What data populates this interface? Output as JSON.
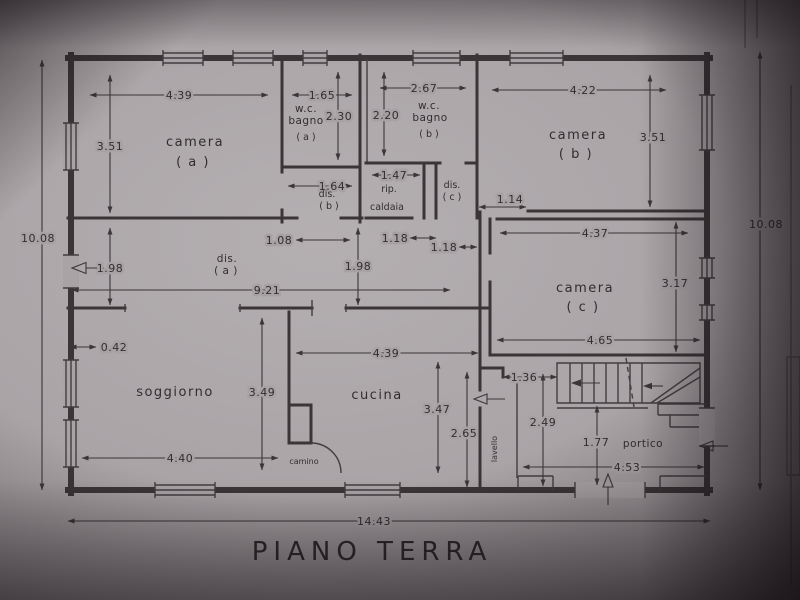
{
  "title": "PIANO TERRA",
  "outer": {
    "left": "10.08",
    "right": "10.08",
    "bottom": "14.43"
  },
  "rooms": {
    "camera_a": {
      "name": "camera",
      "tag": "( a )",
      "width": "4.39",
      "height": "3.51"
    },
    "bagno_a": {
      "l1": "w.c.",
      "l2": "bagno",
      "tag": "( a )",
      "width": "1.65",
      "height": "2.30"
    },
    "bagno_b": {
      "l1": "w.c.",
      "l2": "bagno",
      "tag": "( b )",
      "width": "2.67",
      "height": "2.20"
    },
    "camera_b": {
      "name": "camera",
      "tag": "( b )",
      "width": "4.22",
      "height": "3.51"
    },
    "camera_c": {
      "name": "camera",
      "tag": "( c )",
      "top": "4.37",
      "right": "3.17",
      "bottom": "4.65"
    },
    "dis_a": {
      "l1": "dis.",
      "tag": "( a )",
      "height": "1.98",
      "height2": "1.98",
      "length": "9.21",
      "jog": "0.42"
    },
    "dis_b": {
      "l1": "dis.",
      "tag": "( b )",
      "width": "1.64",
      "opening": "1.08"
    },
    "dis_c": {
      "l1": "dis.",
      "tag": "( c )",
      "opening": "1.18",
      "passage": "1.14"
    },
    "caldaia": {
      "l1": "rip.",
      "l2": "caldaia",
      "width": "1.47",
      "opening": "1.18"
    },
    "soggiorno": {
      "name": "soggiorno",
      "height": "3.49",
      "width": "4.40"
    },
    "cucina": {
      "name": "cucina",
      "width": "4.39",
      "height": "3.47",
      "right": "2.65"
    },
    "camino": {
      "name": "camino"
    },
    "lavello": {
      "name": "lavello",
      "height": "2.49",
      "passage": "1.36"
    },
    "portico": {
      "name": "portico",
      "stair": "1.77",
      "width": "4.53"
    }
  }
}
